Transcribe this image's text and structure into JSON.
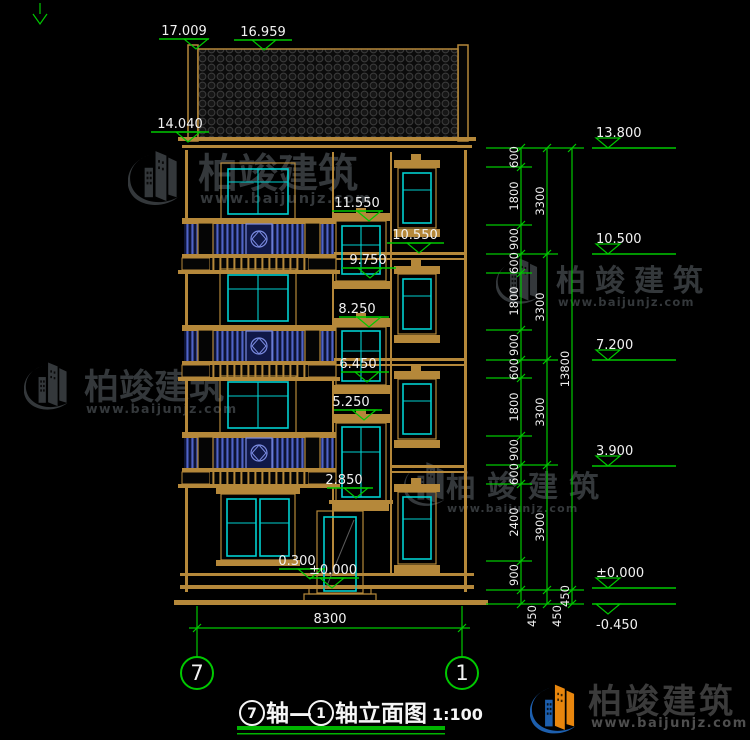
{
  "brand": {
    "name": "柏竣建筑",
    "site": "www.baijunjz.com"
  },
  "title": {
    "axis_start": "7",
    "joiner": "轴—",
    "axis_end": "1",
    "suffix": "轴立面图",
    "scale": "1:100"
  },
  "axis_bubbles": {
    "left": "7",
    "right": "1"
  },
  "levels": {
    "ridge_left": "17.009",
    "ridge_right": "16.959",
    "eave": "14.040",
    "inner": [
      "11.550",
      "10.550",
      "9.750",
      "8.250",
      "6.450",
      "5.250",
      "2.850",
      "0.300",
      "±0.000"
    ],
    "right": [
      "13.800",
      "10.500",
      "7.200",
      "3.900",
      "±0.000",
      "-0.450"
    ]
  },
  "dims": {
    "detail": [
      "600",
      "1800",
      "900",
      "600",
      "1800",
      "900",
      "600",
      "1800",
      "900",
      "600",
      "2400",
      "900",
      "450"
    ],
    "floors": [
      "3300",
      "3300",
      "3300",
      "3900",
      "450"
    ],
    "total": [
      "13800",
      "450"
    ],
    "width": "8300"
  },
  "colors": {
    "background": "#000000",
    "outline": "#b5883a",
    "glass": "#00d0d0",
    "dimension": "#00c800",
    "railing": "#5064c8",
    "text": "#f2f2f2",
    "watermark": "#34383b",
    "logo_orange": "#e8860d",
    "logo_blue": "#1d5fae"
  }
}
